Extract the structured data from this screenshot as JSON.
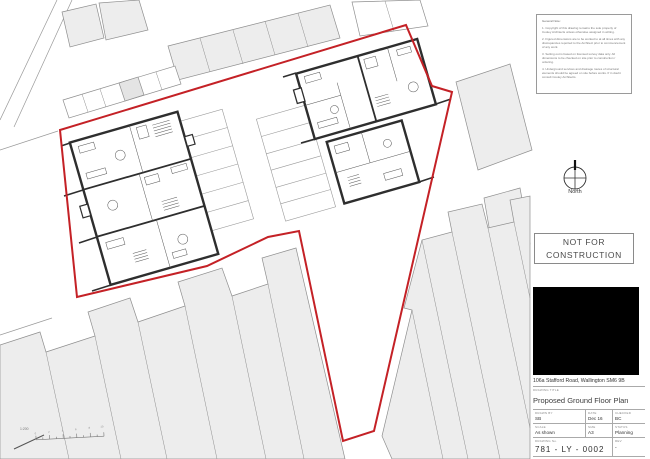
{
  "sheet": {
    "notes": {
      "heading": "General Note:",
      "items": [
        "1.  Copyright of this drawing remains the sole property of Cooley Architects unless otherwise assigned in writing.",
        "2.  Figured dimensions are to be worked to at all times with any discrepancies reported to the Architect prior to commencement of any work.",
        "3.  Setting out is based on licensed survey data only. All dimensions to be checked on site prior to construction / ordering.",
        "4.  Underground services and drainage routes of structural elements should be agreed on site before works. If in doubt consult Cooley Architects."
      ]
    },
    "compass": {
      "label": "North"
    },
    "stamp": {
      "text": "NOT FOR CONSTRUCTION"
    },
    "project": {
      "address": "106a Stafford Road, Wallington SM6 9B"
    },
    "title_block": {
      "drawing_title_label": "DRAWING TITLE",
      "drawing_title": "Proposed Ground Floor Plan",
      "fields": [
        {
          "label": "DRAWN BY",
          "value": "SB"
        },
        {
          "label": "DATE",
          "value": "Dec 16"
        },
        {
          "label": "CHECKED",
          "value": "BC"
        },
        {
          "label": "SCALE",
          "value": "As shown"
        },
        {
          "label": "SIZE",
          "value": "A3"
        },
        {
          "label": "STATUS",
          "value": "Planning"
        }
      ],
      "drawing_no_label": "DRAWING No.",
      "drawing_no": "781  - LY - 0002",
      "rev_label": "REV",
      "rev": "-"
    },
    "scale_bar": {
      "ratio": "1:200",
      "ticks": [
        "0",
        "2",
        "4",
        "6",
        "8",
        "10"
      ]
    },
    "colors": {
      "boundary_red": "#c42126",
      "wall_dark": "#2e2e2e",
      "neighbor_fill": "#ededed",
      "line_gray": "#8f8f8f"
    }
  }
}
